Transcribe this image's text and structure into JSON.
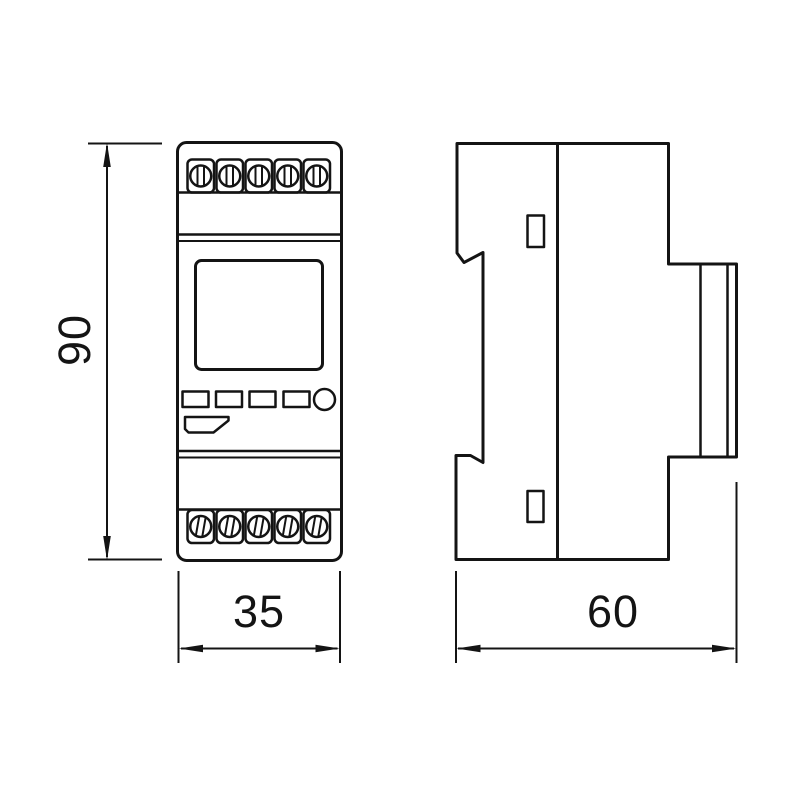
{
  "drawing": {
    "kind": "dimensional-drawing",
    "colors": {
      "line": "#141414",
      "background": "#ffffff"
    },
    "views": {
      "front": {
        "terminals_top_count": 5,
        "terminals_bottom_count": 5,
        "button_count": 4,
        "has_display": true
      },
      "side": {
        "clip_count": 2
      }
    },
    "dimensions": {
      "height_label": "90",
      "width_label": "35",
      "depth_label": "60"
    }
  }
}
